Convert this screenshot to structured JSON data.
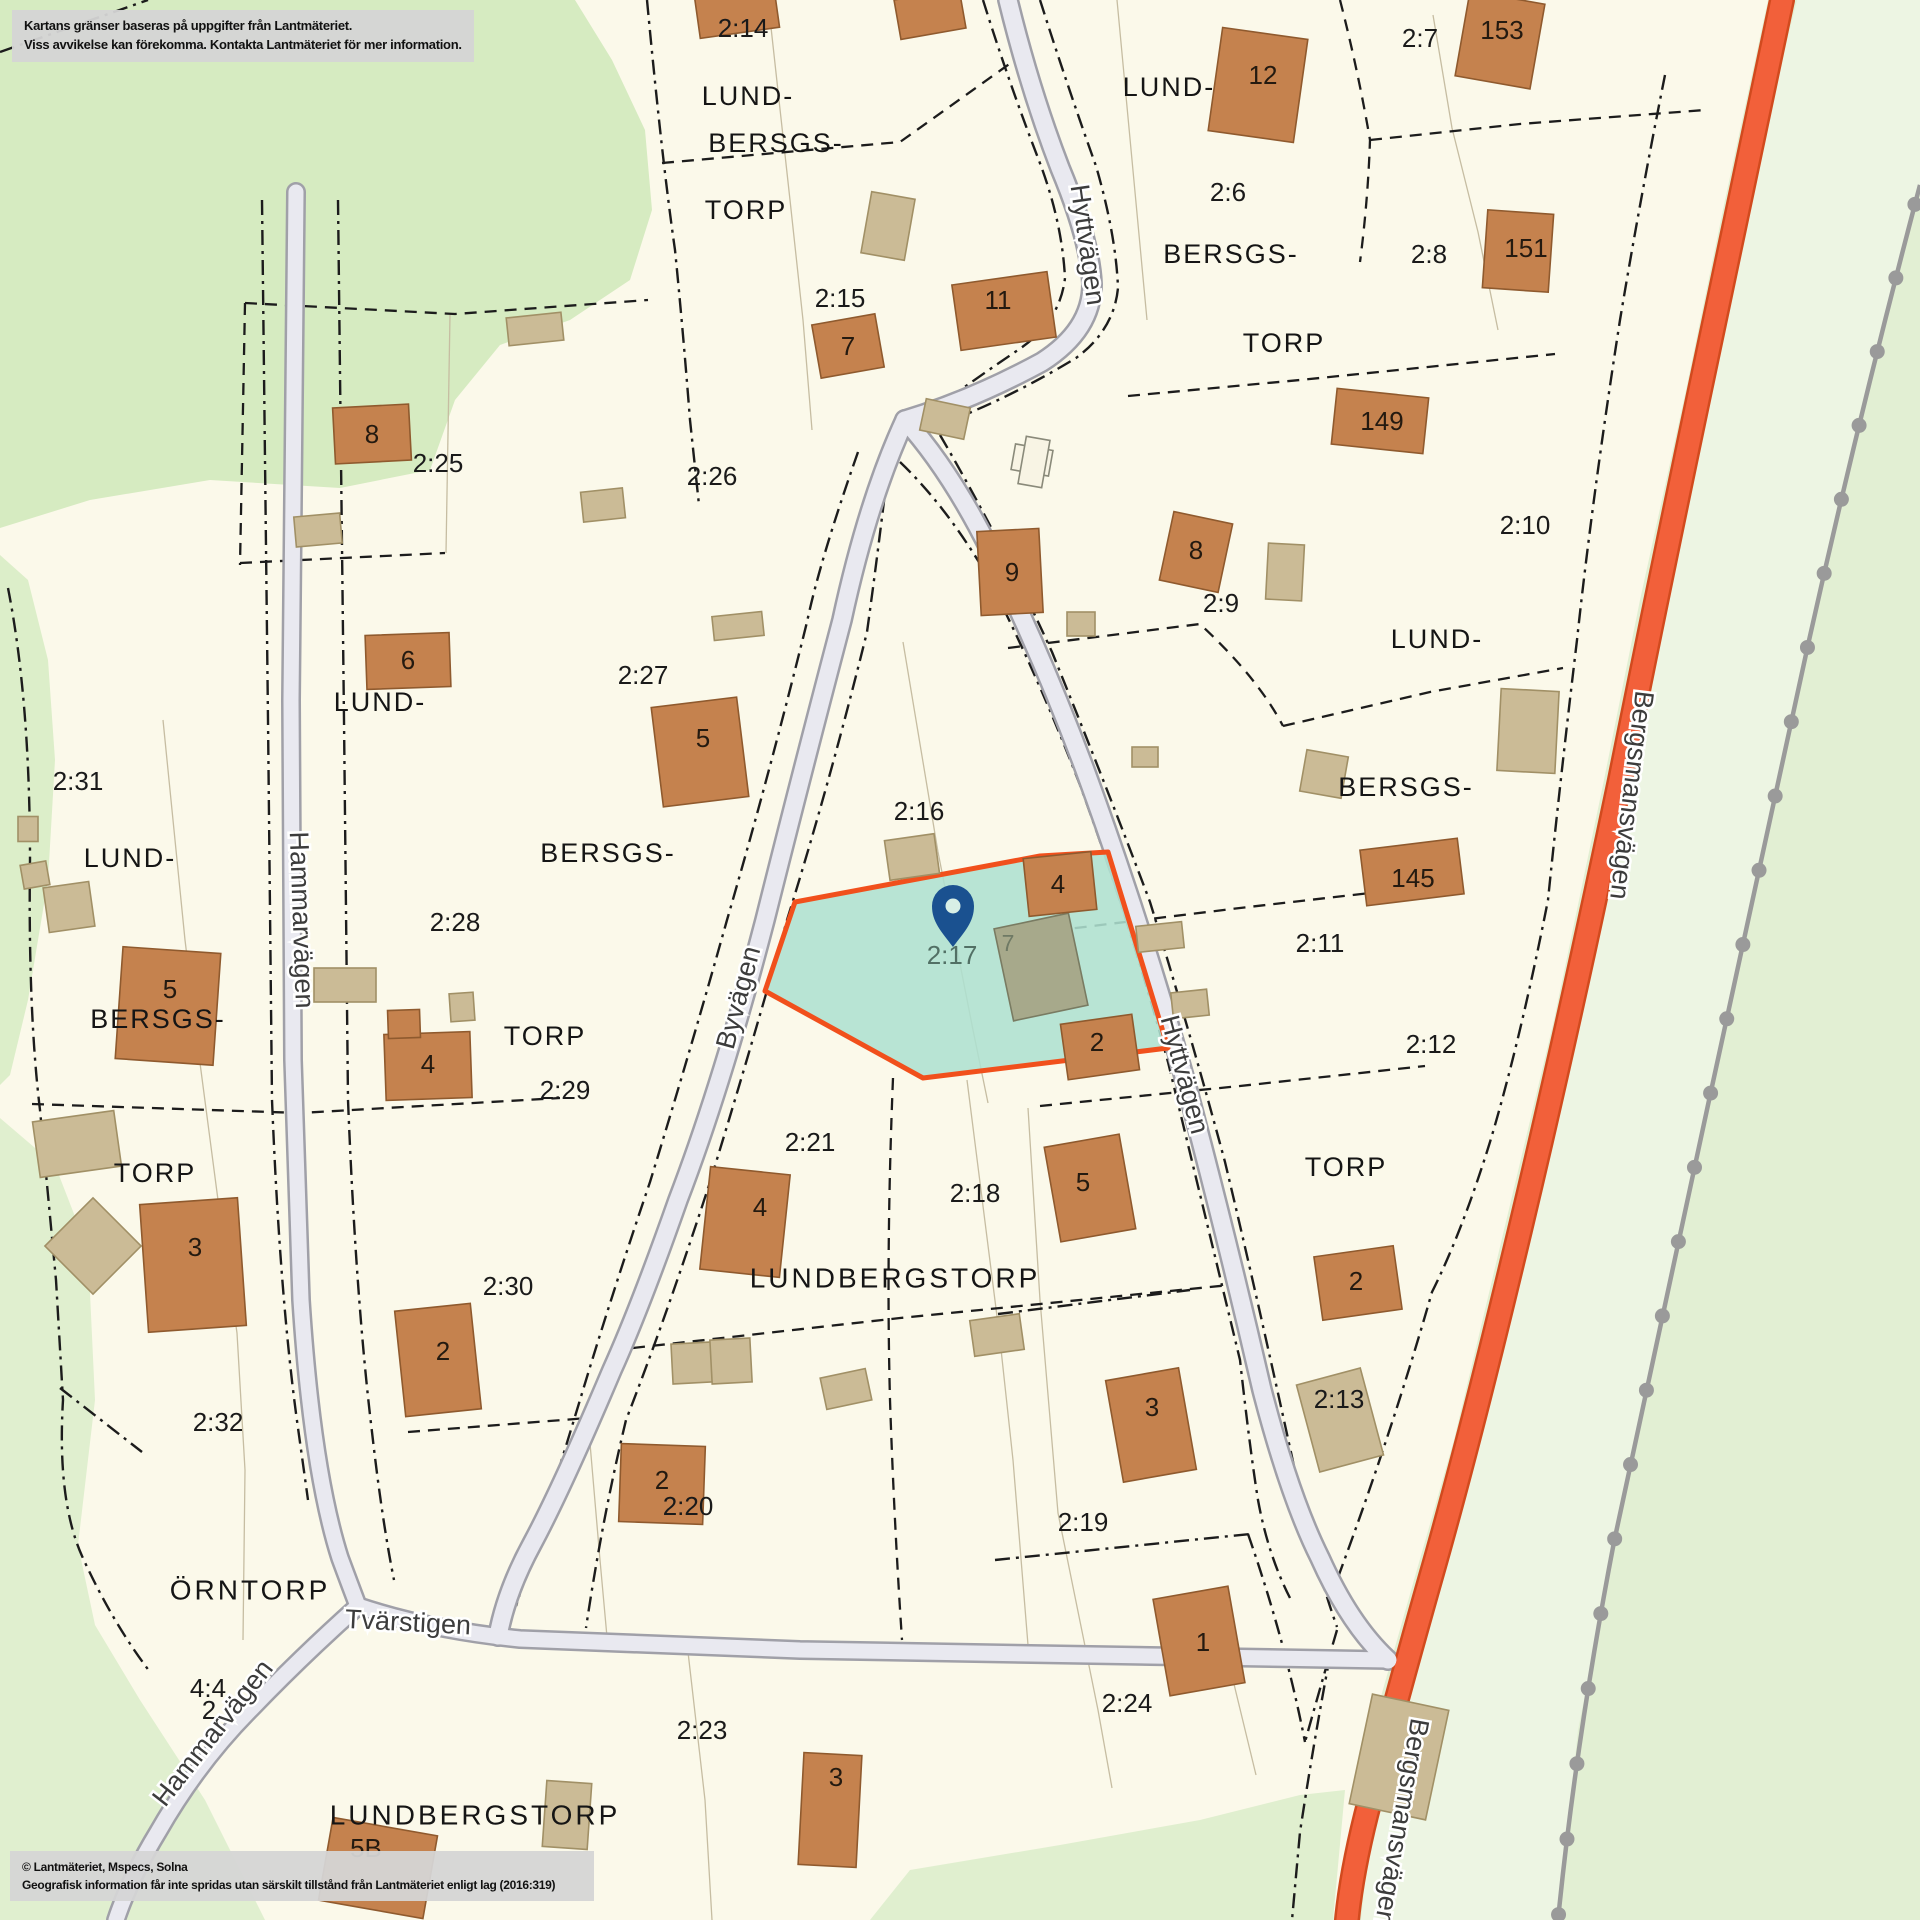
{
  "overlays": {
    "disclaimer_line1": "Kartans gränser baseras på uppgifter från Lantmäteriet.",
    "disclaimer_line2": "Viss avvikelse kan förekomma. Kontakta Lantmäteriet för mer information.",
    "copyright_line1": "© Lantmäteriet, Mspecs, Solna",
    "copyright_line2": "Geografisk information får inte spridas utan särskilt tillstånd från Lantmäteriet enligt lag (2016:319)"
  },
  "colors": {
    "land": "#fbf9ea",
    "green_dark": "#d6ebc1",
    "green_left": "#dceec9",
    "green_bottom_left": "#e0efcf",
    "green_right": "#e2efd3",
    "green_band": "#edf5e3",
    "road_fill": "#e9e9f0",
    "road_casing": "#a0a0a8",
    "main_road_fill": "#f2603a",
    "main_road_casing": "#d14a1e",
    "railway": "#9a9a9a",
    "boundary": "#1c1c1c",
    "thin_line": "#c6bda2",
    "building_fill": "#c5824e",
    "building_stroke": "#8f5a2e",
    "outbuilding_fill": "#cbbb96",
    "outbuilding_stroke": "#a19066",
    "olive_fill": "#a7a98b",
    "olive_stroke": "#797b62",
    "white_bldg_fill": "#f8f4e4",
    "white_bldg_stroke": "#8a8a7a",
    "highlight_fill": "#aee0d0",
    "highlight_stroke": "#f1501c",
    "pin_color": "#1a5190",
    "pin_hole": "#d8efe6"
  },
  "map": {
    "highlight_parcel": {
      "id": "2:17",
      "points": "795,902 1040,856 1108,852 1168,1048 923,1078 765,991"
    },
    "pin": {
      "x": 953,
      "y": 906,
      "tip_y": 947,
      "r": 21,
      "hole_r": 7.5
    },
    "areas": [
      {
        "n": "forest-top-left",
        "fill": "#d6ebc1",
        "pts": "0,0 575,0 612,60 645,130 652,210 630,280 570,320 500,345 455,400 430,470 340,488 210,480 90,500 0,528"
      },
      {
        "n": "forest-left-strip",
        "fill": "#dceec9",
        "pts": "0,555 28,580 48,660 55,760 48,880 28,1000 10,1075 0,1085"
      },
      {
        "n": "forest-bottom-left",
        "fill": "#e0efcf",
        "pts": "0,1118 55,1165 88,1250 95,1400 78,1545 95,1625 140,1700 205,1800 265,1920 0,1920"
      },
      {
        "n": "forest-right",
        "fill": "#e2efd3",
        "pts": "1768,0 1920,0 1920,1920 1333,1920 1356,1800 1380,1700 1414,1580 1454,1440 1504,1230 1554,1020 1604,780 1640,600 1686,390 1725,200"
      },
      {
        "n": "forest-band-right",
        "fill": "#edf5e3",
        "pts": "1797,0 1920,0 1920,185 1863,410 1813,630 1763,860 1713,1090 1663,1320 1618,1530 1578,1730 1558,1920 1361,1920 1372,1810 1396,1710 1430,1590 1470,1450 1520,1240 1570,1030 1620,790 1655,610 1700,400 1745,210"
      },
      {
        "n": "forest-bottom-center",
        "fill": "#e0efcf",
        "pts": "870,1920 910,1870 1060,1845 1200,1820 1300,1795 1345,1790 1333,1920"
      }
    ],
    "thin_lines": [
      "M 768,0 L 790,200 L 803,320 L 812,430",
      "M 1117,0 L 1147,320",
      "M 1433,15 L 1452,128 L 1478,232 L 1498,330",
      "M 163,720 L 185,940 L 200,1063 L 218,1200 L 237,1333 L 245,1470 L 243,1640",
      "M 903,642 L 938,852 L 973,1030 L 988,1103",
      "M 967,1080 L 1000,1340 L 1013,1460 L 1028,1645",
      "M 1028,1108 L 1040,1300 L 1058,1513 L 1098,1710 L 1112,1788",
      "M 688,1652 L 705,1800 L 712,1920",
      "M 1233,1680 L 1256,1775",
      "M 450,315 L 446,553",
      "M 588,1420 L 600,1560 L 608,1648"
    ],
    "boundaries_dashdot": [
      "M 0,52 L 148,0",
      "M 647,0 Q 662,160 675,250 Q 683,330 690,420 L 699,505",
      "M 858,452 Q 820,560 807,622 Q 770,772 727,920 Q 690,1052 650,1182 Q 610,1300 580,1400 Q 546,1512 516,1606",
      "M 888,468 Q 877,560 867,632 Q 830,782 787,920 Q 750,1052 710,1182 Q 668,1312 626,1420 Q 602,1520 586,1628",
      "M 983,0 Q 1008,80 1038,158 Q 1062,220 1065,278 Q 1060,322 1018,350 Q 962,388 912,425",
      "M 900,462 Q 945,505 985,572 Q 1035,668 1080,785 Q 1130,922 1168,1062 Q 1205,1215 1240,1360 Q 1250,1450 1258,1500 Q 1268,1555 1290,1598",
      "M 1040,0 Q 1068,88 1096,166 Q 1116,235 1118,288 Q 1114,330 1076,358 Q 1020,392 962,416",
      "M 940,435 Q 1000,538 1052,652 Q 1108,790 1150,902 Q 1190,1032 1225,1162 Q 1258,1300 1297,1480 Q 1315,1565 1337,1627",
      "M 262,200 L 268,720 L 272,1100 Q 280,1300 298,1428 L 308,1500",
      "M 338,200 L 344,720 L 348,1100 Q 356,1300 372,1432 Q 382,1520 394,1580",
      "M 8,588 Q 30,700 30,860 Q 28,1010 40,1110 L 56,1280 L 63,1400 Q 57,1500 82,1556 Q 112,1622 150,1672",
      "M 1665,75 Q 1640,200 1620,320 Q 1592,500 1577,640 Q 1560,782 1548,900 Q 1520,1042 1490,1142 Q 1462,1232 1432,1292 Q 1392,1432 1337,1580",
      "M 1330,1656 Q 1314,1740 1300,1832 L 1292,1920",
      "M 998,1314 L 1190,1290",
      "M 995,1560 L 1250,1534",
      "M 60,1388 L 142,1452",
      "M 1248,1534 Q 1285,1640 1305,1742 M 1337,1630 Q 1320,1688 1305,1742"
    ],
    "boundaries_dashed": [
      "M 662,163 L 900,142 L 1022,55",
      "M 1340,0 Q 1358,70 1370,140 Q 1368,200 1360,262",
      "M 1370,140 L 1520,124 L 1705,110",
      "M 1128,396 L 1300,380 L 1555,354",
      "M 1008,648 L 1200,624 Q 1258,678 1283,726",
      "M 1283,726 L 1430,692 L 1563,668",
      "M 1035,933 L 1240,908 L 1448,884",
      "M 1040,1106 L 1240,1086 L 1425,1066",
      "M 633,1348 L 900,1318 L 1240,1284",
      "M 32,1104 L 300,1113 L 560,1098",
      "M 245,303 L 455,314 L 648,300",
      "M 245,303 L 240,565",
      "M 240,563 L 445,553",
      "M 893,1078 Q 886,1250 890,1400 Q 894,1520 902,1640",
      "M 408,1432 L 588,1418"
    ],
    "roads": [
      {
        "n": "road-hammarvagen",
        "type": "gray",
        "w": 15,
        "d": "M 296,192 L 291,700 L 293,1060 L 301,1300 Q 312,1470 340,1558 Q 350,1585 358,1606"
      },
      {
        "n": "road-hammarvagen-south",
        "type": "gray",
        "w": 15,
        "d": "M 358,1606 Q 300,1658 252,1708 Q 198,1762 158,1832 Q 130,1878 116,1920"
      },
      {
        "n": "road-tvarstigen",
        "type": "gray",
        "w": 15,
        "d": "M 358,1606 Q 430,1630 520,1639 L 800,1650 L 1150,1656 L 1388,1660"
      },
      {
        "n": "road-byvagen",
        "type": "gray",
        "w": 17,
        "d": "M 905,420 Q 868,500 842,620 Q 800,780 765,920 Q 722,1085 678,1200 Q 640,1308 612,1370 Q 562,1488 532,1544 Q 506,1592 498,1636"
      },
      {
        "n": "road-hyttvagen-north",
        "type": "gray",
        "w": 17,
        "d": "M 1008,0 Q 1030,90 1060,168 Q 1090,240 1092,284 Q 1092,330 1042,362 Q 972,400 905,420"
      },
      {
        "n": "road-hyttvagen",
        "type": "gray",
        "w": 17,
        "d": "M 905,420 Q 950,470 990,550 Q 1040,650 1085,770 Q 1140,920 1185,1080 Q 1225,1230 1262,1390 Q 1290,1498 1320,1558 Q 1350,1625 1388,1660"
      },
      {
        "n": "road-bergsmansvagen",
        "type": "orange",
        "w": 21,
        "d": "M 1782,0 Q 1740,200 1700,390 Q 1656,600 1620,780 Q 1570,1020 1520,1230 Q 1470,1440 1430,1580 Q 1396,1700 1370,1800 Q 1352,1868 1347,1920"
      }
    ],
    "railway": {
      "path": "M 1920,185 Q 1858,420 1808,645 Q 1758,875 1708,1105 Q 1658,1335 1614,1542 Q 1576,1740 1558,1920",
      "width": 4.5,
      "dot_radius": 7.5,
      "dot_spacing": 76
    },
    "buildings_brown": [
      [
        737,
        12,
        80,
        42,
        -8,
        null,
        0,
        0
      ],
      [
        930,
        14,
        66,
        40,
        -10,
        null,
        0,
        0
      ],
      [
        848,
        346,
        64,
        54,
        -10,
        "7",
        848,
        348
      ],
      [
        1004,
        311,
        96,
        66,
        -8,
        "11",
        998,
        302
      ],
      [
        1258,
        85,
        86,
        104,
        8,
        "12",
        1263,
        77
      ],
      [
        1500,
        40,
        76,
        86,
        10,
        "153",
        1502,
        32
      ],
      [
        1518,
        251,
        66,
        78,
        4,
        "151",
        1526,
        250
      ],
      [
        372,
        434,
        76,
        56,
        -3,
        "8",
        372,
        436
      ],
      [
        1380,
        421,
        92,
        56,
        6,
        "149",
        1382,
        423
      ],
      [
        1196,
        552,
        60,
        70,
        12,
        "8",
        1196,
        552
      ],
      [
        1010,
        572,
        62,
        84,
        -3,
        "9",
        1012,
        574
      ],
      [
        700,
        752,
        86,
        100,
        -7,
        "5",
        703,
        740
      ],
      [
        408,
        661,
        84,
        54,
        -2,
        "6",
        408,
        662
      ],
      [
        168,
        1006,
        98,
        112,
        4,
        "5",
        170,
        991
      ],
      [
        428,
        1066,
        86,
        66,
        -2,
        "4",
        428,
        1066
      ],
      [
        404,
        1024,
        32,
        28,
        -2,
        null,
        0,
        0
      ],
      [
        193,
        1265,
        98,
        128,
        -4,
        "3",
        195,
        1249
      ],
      [
        438,
        1360,
        76,
        106,
        -6,
        "2",
        443,
        1353
      ],
      [
        745,
        1222,
        80,
        103,
        6,
        "4",
        760,
        1209
      ],
      [
        1090,
        1188,
        76,
        96,
        -10,
        "5",
        1083,
        1184
      ],
      [
        662,
        1484,
        84,
        78,
        2,
        "2",
        662,
        1482
      ],
      [
        1151,
        1425,
        74,
        103,
        -10,
        "3",
        1152,
        1409
      ],
      [
        1358,
        1283,
        80,
        64,
        -8,
        "2",
        1356,
        1283
      ],
      [
        1199,
        1641,
        76,
        98,
        -10,
        "1",
        1203,
        1644
      ],
      [
        830,
        1810,
        58,
        112,
        3,
        "3",
        836,
        1779
      ],
      [
        378,
        1868,
        106,
        84,
        10,
        "5B",
        366,
        1850
      ],
      [
        1412,
        872,
        98,
        56,
        -7,
        "145",
        1413,
        880
      ],
      [
        1060,
        884,
        68,
        58,
        -6,
        "4",
        1058,
        886
      ],
      [
        1100,
        1047,
        72,
        56,
        -8,
        "2",
        1097,
        1044
      ]
    ],
    "buildings_tan": [
      [
        535,
        329,
        55,
        28,
        -6
      ],
      [
        603,
        505,
        42,
        30,
        -6
      ],
      [
        888,
        226,
        44,
        62,
        10
      ],
      [
        945,
        419,
        45,
        32,
        12
      ],
      [
        318,
        530,
        46,
        30,
        -5
      ],
      [
        1081,
        624,
        28,
        24,
        0
      ],
      [
        912,
        857,
        50,
        40,
        -8
      ],
      [
        738,
        626,
        50,
        24,
        -6
      ],
      [
        69,
        907,
        46,
        45,
        -8
      ],
      [
        28,
        829,
        20,
        25,
        0
      ],
      [
        35,
        875,
        26,
        24,
        -10
      ],
      [
        77,
        1144,
        82,
        56,
        -8
      ],
      [
        93,
        1246,
        68,
        68,
        45
      ],
      [
        345,
        985,
        62,
        34,
        0
      ],
      [
        1528,
        731,
        58,
        82,
        3
      ],
      [
        1324,
        774,
        42,
        42,
        10
      ],
      [
        1160,
        937,
        46,
        26,
        -6
      ],
      [
        1190,
        1004,
        36,
        26,
        -6
      ],
      [
        1340,
        1420,
        66,
        90,
        -15
      ],
      [
        692,
        1363,
        40,
        40,
        -3
      ],
      [
        731,
        1361,
        40,
        44,
        -3
      ],
      [
        997,
        1335,
        50,
        36,
        -8
      ],
      [
        846,
        1389,
        46,
        32,
        -12
      ],
      [
        567,
        1815,
        45,
        66,
        4
      ],
      [
        1399,
        1757,
        78,
        112,
        12
      ],
      [
        1285,
        572,
        36,
        56,
        3
      ],
      [
        462,
        1007,
        24,
        28,
        -4
      ],
      [
        1145,
        757,
        26,
        20,
        0
      ]
    ],
    "buildings_olive": [
      [
        1041,
        967,
        76,
        94,
        -12
      ]
    ],
    "buildings_white": [
      [
        1032,
        460,
        38,
        26,
        10
      ],
      [
        1034,
        462,
        24,
        48,
        10
      ]
    ],
    "labels": [
      [
        "2:14",
        743,
        30,
        "parcel",
        0
      ],
      [
        "2:15",
        840,
        300,
        "parcel",
        0
      ],
      [
        "2:25",
        438,
        465,
        "parcel",
        0
      ],
      [
        "2:26",
        712,
        478,
        "parcel",
        0
      ],
      [
        "2:27",
        643,
        677,
        "parcel",
        0
      ],
      [
        "2:28",
        455,
        924,
        "parcel",
        0
      ],
      [
        "2:29",
        565,
        1092,
        "parcel",
        0
      ],
      [
        "2:30",
        508,
        1288,
        "parcel",
        0
      ],
      [
        "2:31",
        78,
        783,
        "parcel",
        0
      ],
      [
        "2:32",
        218,
        1424,
        "parcel",
        0
      ],
      [
        "2:6",
        1228,
        194,
        "parcel",
        0
      ],
      [
        "2:7",
        1420,
        40,
        "parcel",
        0
      ],
      [
        "2:8",
        1429,
        256,
        "parcel",
        0
      ],
      [
        "2:9",
        1221,
        605,
        "parcel",
        0
      ],
      [
        "2:10",
        1525,
        527,
        "parcel",
        0
      ],
      [
        "2:11",
        1320,
        945,
        "parcel",
        0
      ],
      [
        "2:12",
        1431,
        1046,
        "parcel",
        0
      ],
      [
        "2:13",
        1339,
        1401,
        "parcel",
        0
      ],
      [
        "2:16",
        919,
        813,
        "parcel",
        0
      ],
      [
        "2:18",
        975,
        1195,
        "parcel",
        0
      ],
      [
        "2:19",
        1083,
        1524,
        "parcel",
        0
      ],
      [
        "2:20",
        688,
        1508,
        "parcel",
        0
      ],
      [
        "2:21",
        810,
        1144,
        "parcel",
        0
      ],
      [
        "2:23",
        702,
        1732,
        "parcel",
        0
      ],
      [
        "2:24",
        1127,
        1705,
        "parcel",
        0
      ],
      [
        "4:4",
        208,
        1690,
        "parcel",
        0
      ],
      [
        "2",
        209,
        1712,
        "parcel",
        0
      ],
      [
        "2:17",
        952,
        957,
        "muted",
        0
      ],
      [
        "7",
        1008,
        945,
        "muted2",
        0
      ],
      [
        "LUND-",
        748,
        98,
        "place",
        0
      ],
      [
        "BERSGS-",
        776,
        145,
        "place",
        0
      ],
      [
        "TORP",
        746,
        212,
        "place",
        0
      ],
      [
        "LUND-",
        1169,
        89,
        "place",
        0
      ],
      [
        "BERSGS-",
        1231,
        256,
        "place",
        0
      ],
      [
        "TORP",
        1284,
        345,
        "place",
        0
      ],
      [
        "LUND-",
        1437,
        641,
        "place",
        0
      ],
      [
        "BERSGS-",
        1406,
        789,
        "place",
        0
      ],
      [
        "TORP",
        1346,
        1169,
        "place",
        0
      ],
      [
        "LUND-",
        380,
        704,
        "place",
        0
      ],
      [
        "BERSGS-",
        608,
        855,
        "place",
        0
      ],
      [
        "TORP",
        545,
        1038,
        "place",
        0
      ],
      [
        "LUND-",
        130,
        860,
        "place",
        0
      ],
      [
        "BERSGS-",
        158,
        1021,
        "place",
        0
      ],
      [
        "TORP",
        155,
        1175,
        "place",
        0
      ],
      [
        "LUNDBERGSTORP",
        895,
        1280,
        "placebig",
        0
      ],
      [
        "LUNDBERGSTORP",
        475,
        1817,
        "placebig",
        0
      ],
      [
        "ÖRNTORP",
        250,
        1592,
        "placebig",
        0
      ],
      [
        "Hyttvägen",
        1086,
        245,
        "road",
        82
      ],
      [
        "Hyttvägen",
        1183,
        1075,
        "road",
        75
      ],
      [
        "Byvägen",
        740,
        998,
        "road",
        -75
      ],
      [
        "Hammarvägen",
        300,
        920,
        "road",
        88
      ],
      [
        "Hammarvägen",
        214,
        1734,
        "road",
        -52
      ],
      [
        "Tvärstigen",
        408,
        1624,
        "road",
        3
      ],
      [
        "Bergsmansvägen",
        1630,
        795,
        "road",
        97
      ],
      [
        "Bergsmansvägen",
        1400,
        1822,
        "road",
        100
      ]
    ]
  }
}
